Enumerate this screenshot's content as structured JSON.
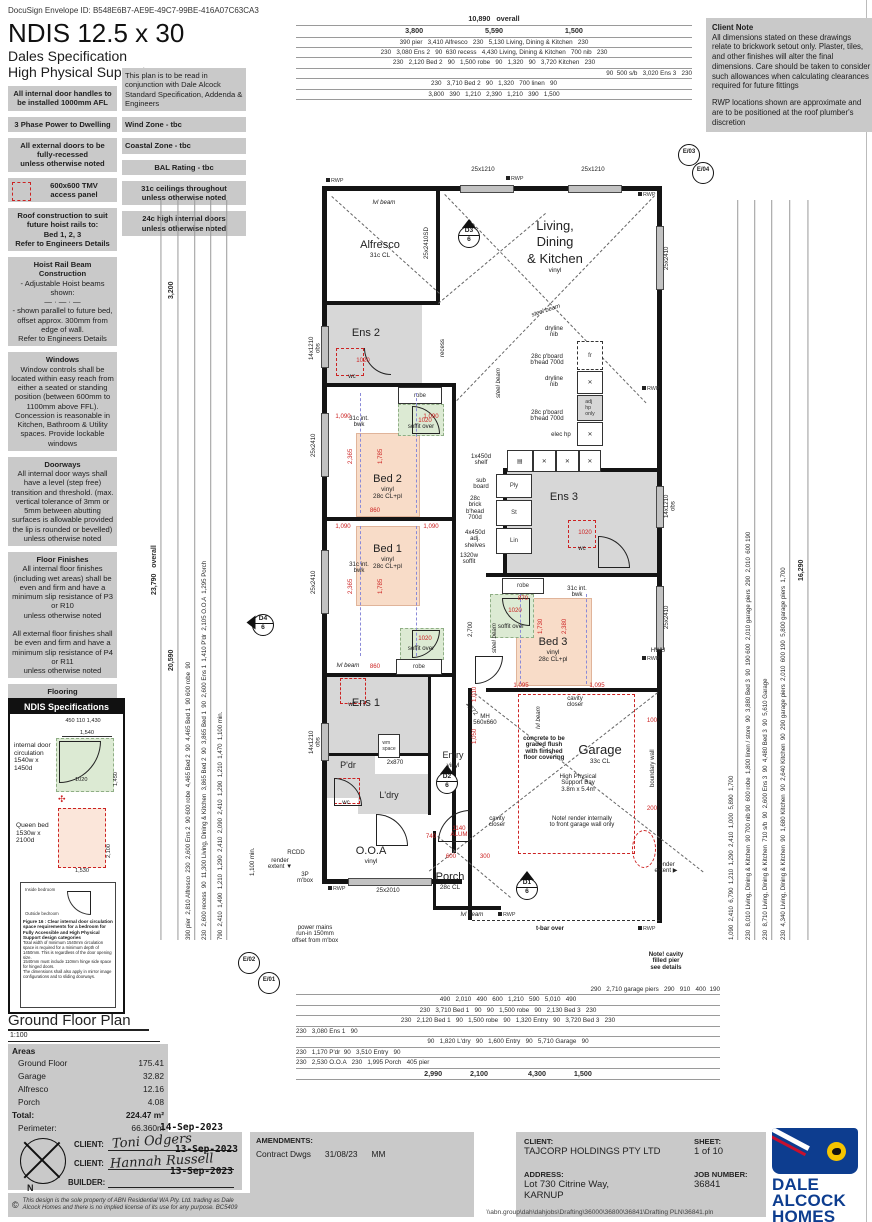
{
  "hdr": {
    "docusign": "DocuSign Envelope ID: B548E6B7-AE9E-49C7-99BE-416A07C63CA3",
    "title": "NDIS 12.5 x 30",
    "sub1": "Dales Specification",
    "sub2": "High Physical Support"
  },
  "nl": [
    {
      "t": "",
      "b": "All internal door handles to be installed 1000mm AFL"
    },
    {
      "t": "3 Phase Power to Dwelling",
      "b": ""
    },
    {
      "t": "",
      "b": "All external doors to be\nfully-recessed\nunless otherwise noted"
    },
    {
      "t": "",
      "b": "600x600 TMV\naccess panel"
    },
    {
      "t": "Roof construction to suit future hoist rails to:",
      "b": "Bed 1, 2, 3\nRefer to Engineers Details"
    },
    {
      "t": "Hoist Rail Beam Construction",
      "b": "- Adjustable Hoist beams shown:\n—  ·  —  ·  —\n- shown parallel to future bed, offset approx. 300mm from edge of wall.\nRefer to Engineers Details"
    },
    {
      "t": "Windows",
      "b": "Window controls shall be located within easy reach from either a seated or standing position (between 600mm to 1100mm above FFL). Concession is reasonable in Kitchen, Bathroom & Utility spaces. Provide lockable windows"
    },
    {
      "t": "Doorways",
      "b": "All internal door ways shall have a level (step free) transition and threshold. (max. vertical tolerance of 3mm or 5mm between abutting surfaces is allowable provided the lip is rounded or bevelled)\nunless otherwise noted"
    },
    {
      "t": "Floor Finishes",
      "b": "All internal floor finishes (including wet areas) shall be even and firm and have a minimum slip resistance of P3 or R10\nunless otherwise noted\n\nAll external floor finishes shall be even and firm and have a minimum slip resistance of P4 or R11\nunless otherwise noted"
    },
    {
      "t": "Flooring",
      "b": "All internal and external flooring (including wet areas) shall be firm, even and feature a level transition between abutting surfaces of a maximum vertical tolerance of 3mm or 5mm (provided the lip is bevelled)\nunless otherwise noted"
    }
  ],
  "nm": [
    {
      "b": "This plan is to be read in conjunction with Dale Alcock Standard Specification, Addenda & Engineers"
    },
    {
      "b": "Wind Zone - tbc"
    },
    {
      "b": "Coastal Zone - tbc"
    },
    {
      "b": "BAL Rating - tbc"
    },
    {
      "b": "31c ceilings throughout\nunless otherwise noted"
    },
    {
      "b": "24c high internal doors\nunless otherwise noted"
    }
  ],
  "cn": {
    "title": "Client Note",
    "p1": "All dimensions stated on these drawings relate to brickwork setout only. Plaster, tiles, and other finishes will alter the final dimensions. Care should be taken to consider such allowances when calculating clearances required for future fittings",
    "p2": "RWP locations shown are approximate and are to be positioned at the roof plumber's discretion"
  },
  "dims": {
    "top": [
      "10,890   overall",
      "3,800                               5,590                               1,500",
      "390 pier   3,410 Alfresco   230   5,130 Living, Dining & Kitchen   230",
      "230   3,080 Ens 2   90  630 recess   4,430 Living, Dining & Kitchen   700 nib   230",
      "230   2,120 Bed 2   90   1,500 robe   90   1,320   90   3,720 Kitchen   230",
      "90  500 s/b   3,020 Ens 3   230",
      "230   3,710 Bed 2   90   1,320   700 linen   90",
      "3,800   390   1,210   2,390   1,210   390   1,500"
    ],
    "bot": [
      "290   2,710 garage piers   290   910   400  190",
      "490   2,010   490   600   1,210   590   5,010   490",
      "230   3,710 Bed 1   90   90   1,500 robe   90   2,130 Bed 3   230",
      "230   2,120 Bed 1   90   1,500 robe   90   1,320 Entry   90   3,720 Bed 3   230",
      "230   3,080 Ens 1   90",
      "90   1,820 L'dry   90   1,600 Entry   90   5,710 Garage   90",
      "230   1,170 P'dr  90   3,510 Entry   90",
      "230   2,530 O.O.A   230   1,995 Porch   405 pier",
      "2,990              2,100                    4,300              1,500"
    ],
    "left": [
      "23,790   overall",
      "3,200",
      "20,590",
      "390 pier  2,810 Alfresco  230  2,600 Ens 2  90 600 robe  4,465 Bed 2  90  4,465 Bed 1  90 600 robe  90",
      "230  2,600 recess  90  11,300 Living, Dining & Kitchen  3,865 Bed 2  90  3,865 Bed 1  90  2,600 Ens 1  1,410 P'dr  2,105 O.O.A  1,295 Porch",
      "790  2,410  1,490  1,210  1,290  2,410  2,090  2,410  1,290  1,210  1,470  1,100 min."
    ],
    "right": [
      "1,090  2,410  6,790  1,210  1,290  2,410  1,000  5,890  1,700",
      "230  8,010 Living, Dining & Kitchen  90 700 nib 90  600 robe  1,800 linen / store  90  3,880 Bed 3  90  190 600  2,010 garage piers  290  2,010  600 190",
      "230  8,710 Living, Dining & Kitchen  710 s/b  90  2,600 Ens 3  90  4,480 Bed 3  90  5,610 Garage",
      "230  4,340 Living, Dining & Kitchen  90  1,680 Kitchen  90  2,640 Kitchen  90  290 garage piers  2,010  600 190  5,800 garage piers  1,700",
      "16,290"
    ]
  },
  "rooms": {
    "alf": {
      "n": "Alfresco",
      "s": "31c CL"
    },
    "ldk": {
      "n": "Living,\nDining\n& Kitchen",
      "s": "vinyl"
    },
    "ens2": {
      "n": "Ens 2",
      "s": ""
    },
    "bed2": {
      "n": "Bed 2",
      "s": "vinyl\n28c CL+pl"
    },
    "bed1": {
      "n": "Bed 1",
      "s": "vinyl\n28c CL+pl"
    },
    "ens3": {
      "n": "Ens 3",
      "s": ""
    },
    "bed3": {
      "n": "Bed 3",
      "s": "vinyl\n28c CL+pl"
    },
    "ens1": {
      "n": "Ens 1",
      "s": ""
    },
    "pdr": {
      "n": "P'dr",
      "s": ""
    },
    "ldry": {
      "n": "L'dry",
      "s": ""
    },
    "ooa": {
      "n": "O.O.A",
      "s": "vinyl"
    },
    "entry": {
      "n": "Entry",
      "s": "vinyl"
    },
    "porch": {
      "n": "Porch",
      "s": "28c CL"
    },
    "garage": {
      "n": "Garage",
      "s": "33c CL"
    }
  },
  "lbl": {
    "steel": "steel beam",
    "dryline": "dryline\nnib",
    "pboard": "28c p'board\nb'head 700d",
    "elec": "elec hp",
    "fr": "fr",
    "adjhp": "adj\nhp\nonly",
    "hwu": "HWU",
    "rwp": "RWP",
    "ply": "Ply",
    "st": "St",
    "lin": "Lin",
    "subboard": "sub\nboard",
    "brick": "28c\nbrick\nb'head\n700d",
    "shelf1": "1x450d\nshelf",
    "shelves4": "4x450d\nadj.\nshelves",
    "soffit1320": "1320w\nsoffit",
    "soffitover": "soffit over",
    "robe": "robe",
    "recess": "recess",
    "wc": "wc",
    "mh": "MH\n560x660",
    "cavity": "cavity\ncloser",
    "alum": "1140\nALUM",
    "concrete": "concrete to be\ngraded flush\nwith finished\nfloor covering",
    "hps": "High Physical\nSupport Bay\n3.8m x 5.4m",
    "noterender": "Note! render internally\nto front garage wall only",
    "notecavity": "Note! cavity\nfilled pier\nsee details",
    "tbar": "t-bar over",
    "boundary": "boundary wall",
    "lvlbeam": "lvl beam",
    "intbwk": "31c int.\nbwk",
    "obs": "obs",
    "pm": "power mains\nrun-in 150mm\noffset from m'box",
    "rext": "render\nextent",
    "rcdd": "RCDD",
    "mbox": "3P\nm'box",
    "w25x1210": "25x1210",
    "w25x2410sd": "25x2410SD",
    "w25x2410": "25x2410",
    "w14x1210": "14x1210\nobs",
    "w25x2010": "25x2010",
    "d2x870": "2x870",
    "wmspace": "wm\nspace",
    "r1020": "1020",
    "r1090": "1,090",
    "r2365": "2,365",
    "r1785": "1,785",
    "r860": "860",
    "r1095": "1,095",
    "r2380": "2,380",
    "r1730": "1,730",
    "r870": "870",
    "r2700": "2,700",
    "r1372": "1,372",
    "r740": "740",
    "r600": "600",
    "r300": "300",
    "r100": "100",
    "r200": "200",
    "r1010": "1,010",
    "r1050": "1,050"
  },
  "mk": {
    "d1": "D1",
    "d2": "D2",
    "d3": "D3",
    "d4": "D4",
    "six": "6",
    "e01": "E/01",
    "e02": "E/02",
    "e03": "E/03",
    "e04": "E/04",
    "north": "N"
  },
  "ndis": {
    "title": "NDIS Specifications",
    "i1": {
      "label": "internal door\ncirculation\n1540w x 1450d",
      "top": "450 110    1,430",
      "w": "1,540",
      "d": "1,450",
      "open": "1020"
    },
    "i2": {
      "label": "Queen bed\n1530w x 2100d",
      "d": "2,100",
      "w": "1,530"
    },
    "fig": {
      "caption": "Figure 16 : Clear internal door circulation space requirements for a bedroom for Fully Accessible and High Physical Support design categories",
      "inside": "Inside bedroom",
      "outside": "Outside bedroom",
      "n1": "Total width of minimum 1540mm circulation space is required for a minimum depth of 1450mm. This is regardless of the door opening size.",
      "n2": "1540mm must include 110mm hinge side space for hinged doors.",
      "n3": "The dimensions shall also apply in mirror image configurations and to sliding doorways."
    }
  },
  "gf": {
    "title": "Ground Floor Plan",
    "scale": "1:100",
    "areas": "Areas",
    "rows": [
      {
        "l": "Ground Floor",
        "v": "175.41"
      },
      {
        "l": "Garage",
        "v": "32.82"
      },
      {
        "l": "Alfresco",
        "v": "12.16"
      },
      {
        "l": "Porch",
        "v": "4.08"
      }
    ],
    "total_l": "Total:",
    "total_v": "224.47 m²",
    "per_l": "Perimeter:",
    "per_v": "66.360m"
  },
  "tb": {
    "client_l": "CLIENT:",
    "builder_l": "BUILDER:",
    "sig1": "Toni Odgers",
    "sig2": "Hannah Russell",
    "date1": "14-Sep-2023",
    "date2": "13-Sep-2023",
    "date3": "13-Sep-2023",
    "copy": "This design is the sole property of ABN Residential WA Pty. Ltd. trading as Dale Alcock Homes and there is no implied license of its use for any purpose. BC5409",
    "am_l": "AMENDMENTS:",
    "am1": {
      "a": "Contract Dwgs",
      "b": "31/08/23",
      "c": "MM"
    },
    "cl_l": "CLIENT:",
    "cl": "TAJCORP HOLDINGS PTY LTD",
    "ad_l": "ADDRESS:",
    "ad": "Lot 730 Citrine Way,\nKARNUP",
    "sh_l": "SHEET:",
    "sh": "1 of 10",
    "job_l": "JOB NUMBER:",
    "job": "36841",
    "logo1": "DALE",
    "logo2": "ALCOCK",
    "logo3": "HOMES",
    "path": "\\\\abn.group\\dah\\dahjobs\\Drafting\\36000\\36800\\36841\\Drafting PLN\\36841.pln"
  }
}
